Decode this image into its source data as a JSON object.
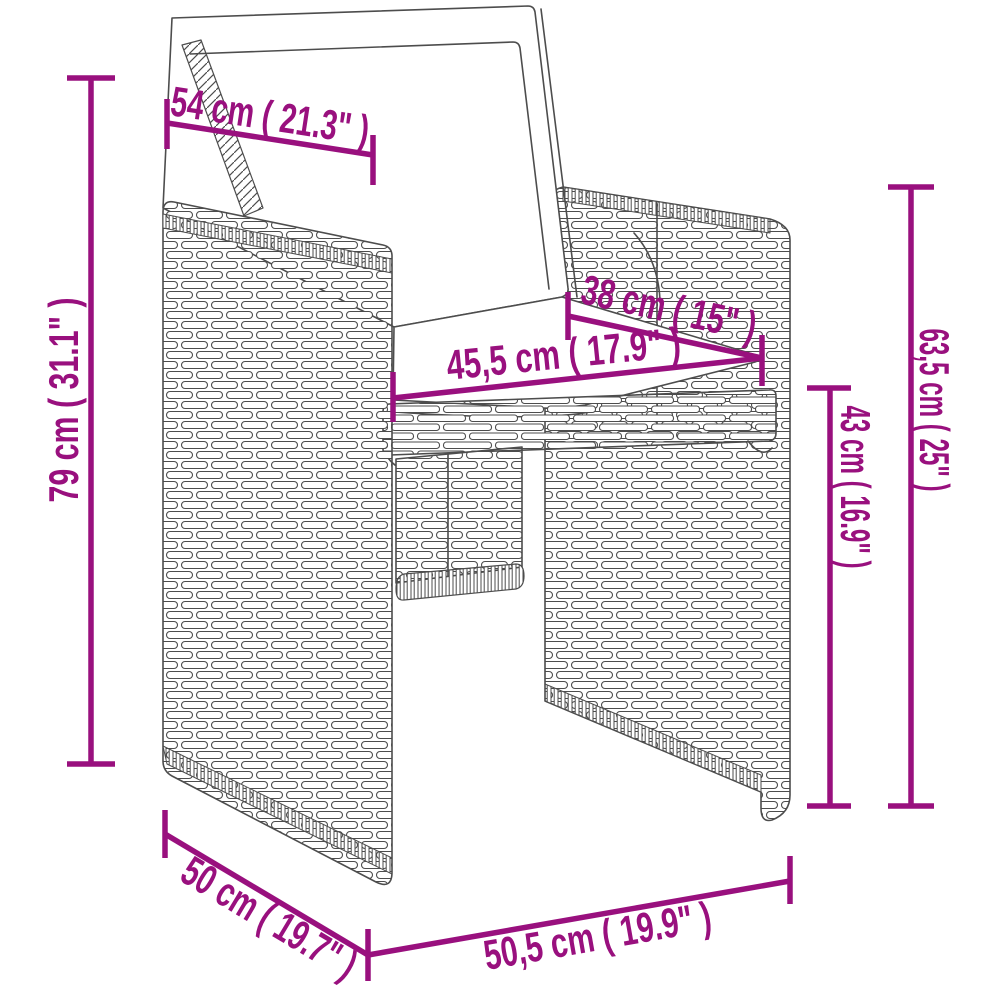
{
  "diagram": {
    "subject": "poly rattan garden armchair with cushions - line drawing",
    "background_color": "#ffffff",
    "line_art_color": "#4d4d4d",
    "accent_color": "#99107E",
    "dimensions": [
      {
        "id": "backrest-cushion-width",
        "label": "54 cm ( 21.3\" )"
      },
      {
        "id": "overall-height",
        "label": "79 cm ( 31.1\" )"
      },
      {
        "id": "seat-depth",
        "label": "38 cm ( 15\" )"
      },
      {
        "id": "seat-width",
        "label": "45,5 cm ( 17.9\" )"
      },
      {
        "id": "armrest-height",
        "label": "63,5 cm ( 25\" )"
      },
      {
        "id": "seat-height",
        "label": "43 cm ( 16.9\" )"
      },
      {
        "id": "side-depth",
        "label": "50 cm ( 19.7\" )"
      },
      {
        "id": "front-width",
        "label": "50,5 cm ( 19.9\" )"
      }
    ]
  }
}
